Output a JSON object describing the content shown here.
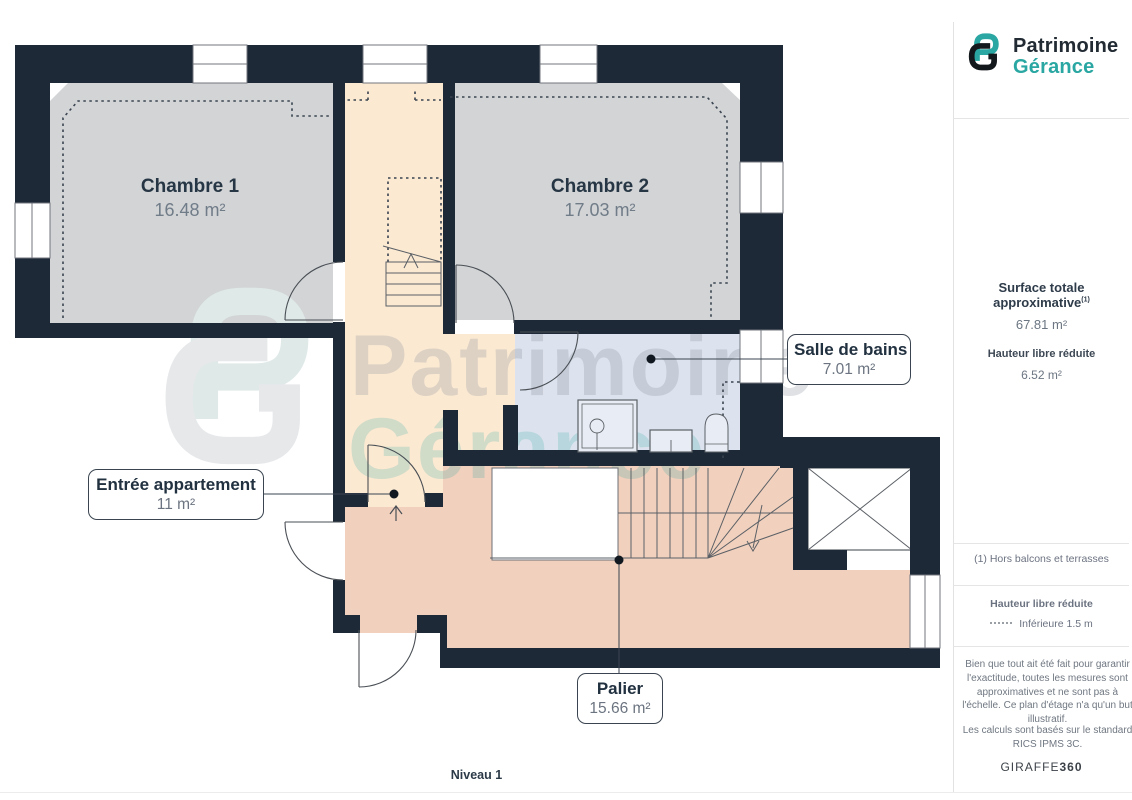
{
  "brand": {
    "line1": "Patrimoine",
    "line2": "Gérance"
  },
  "sidebar": {
    "surface_label": "Surface totale approximative",
    "surface_sup": "(1)",
    "surface_value": "67.81 m²",
    "reduced_height_label": "Hauteur libre réduite",
    "reduced_height_value": "6.52 m²",
    "footnote": "(1) Hors balcons et terrasses",
    "legend_title": "Hauteur libre réduite",
    "legend_item": "Inférieure 1.5 m",
    "disclaimer1": "Bien que tout ait été fait pour garantir l'exactitude, toutes les mesures sont approximatives et ne sont pas à l'échelle. Ce plan d'étage n'a qu'un but illustratif.",
    "disclaimer2": "Les calculs sont basés sur le standard RICS IPMS 3C.",
    "credit_normal": "GIRAFFE",
    "credit_bold": "360"
  },
  "plan": {
    "level_label": "Niveau 1",
    "rooms": [
      {
        "name": "Chambre 1",
        "area": "16.48 m²"
      },
      {
        "name": "Chambre 2",
        "area": "17.03 m²"
      },
      {
        "name": "Salle de bains",
        "area": "7.01 m²"
      },
      {
        "name": "Entrée appartement",
        "area": "11 m²"
      },
      {
        "name": "Palier",
        "area": "15.66 m²"
      }
    ],
    "watermark1": "Patrimoine",
    "watermark2": "Gérance",
    "colors": {
      "wall": "#1e2937",
      "bedroom_fill": "#d2d4d6",
      "hall_fill": "#fbe9d2",
      "bathroom_fill": "#dde3ee",
      "landing_fill": "#f1d0bd",
      "brand_teal": "#2aa7a2",
      "brand_dark": "#222b33"
    }
  }
}
